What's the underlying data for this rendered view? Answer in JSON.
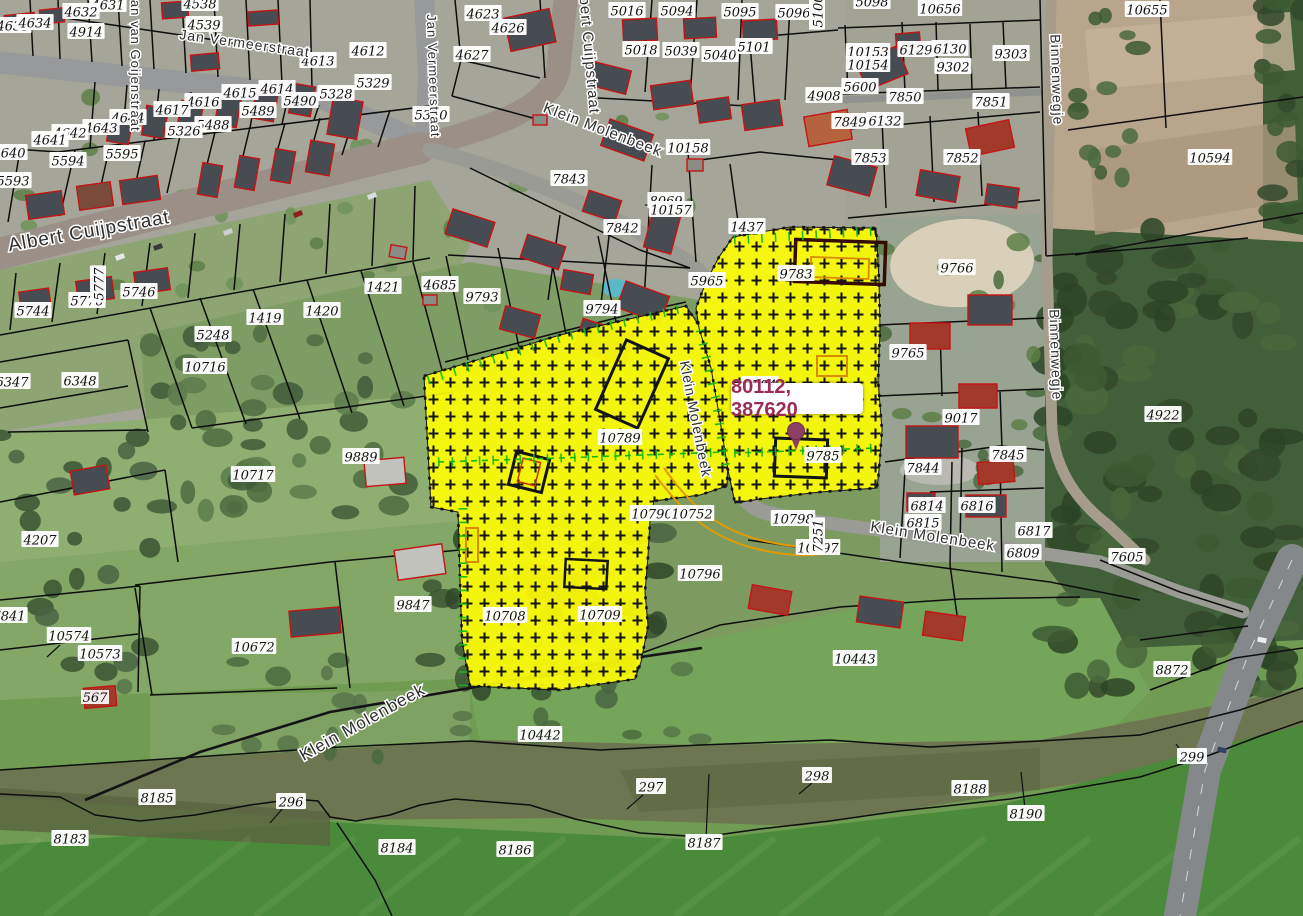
{
  "app": {
    "type": "cadastral-map-viewer",
    "description": "Aerial photo with cadastral parcels"
  },
  "map": {
    "coordinate_label": {
      "text": "80112, 387620",
      "color": "#9c2b58"
    },
    "marker": {
      "x": 796,
      "y": 431,
      "color": "#8d3f63"
    },
    "highlight": {
      "color": "#fdfc05",
      "pattern": "plus-hatch",
      "selected_parcels": [
        "10789",
        "10708",
        "10709",
        "9783",
        "9784",
        "9785"
      ]
    },
    "parcel_labels": [
      {
        "t": "4631",
        "x": 108,
        "y": 7
      },
      {
        "t": "4632",
        "x": 81,
        "y": 14
      },
      {
        "t": "4635",
        "x": 13,
        "y": 28
      },
      {
        "t": "4634",
        "x": 35,
        "y": 25
      },
      {
        "t": "4914",
        "x": 86,
        "y": 34
      },
      {
        "t": "4538",
        "x": 200,
        "y": 6
      },
      {
        "t": "4539",
        "x": 204,
        "y": 27
      },
      {
        "t": "4623",
        "x": 483,
        "y": 16
      },
      {
        "t": "4626",
        "x": 508,
        "y": 30
      },
      {
        "t": "4627",
        "x": 472,
        "y": 57
      },
      {
        "t": "4612",
        "x": 368,
        "y": 53
      },
      {
        "t": "4613",
        "x": 318,
        "y": 63
      },
      {
        "t": "4615",
        "x": 240,
        "y": 95
      },
      {
        "t": "4614",
        "x": 277,
        "y": 91
      },
      {
        "t": "4616",
        "x": 203,
        "y": 104
      },
      {
        "t": "4617",
        "x": 172,
        "y": 112
      },
      {
        "t": "4644",
        "x": 128,
        "y": 120
      },
      {
        "t": "4643",
        "x": 101,
        "y": 130
      },
      {
        "t": "4642",
        "x": 70,
        "y": 135
      },
      {
        "t": "4641",
        "x": 50,
        "y": 142
      },
      {
        "t": "4640",
        "x": 9,
        "y": 155
      },
      {
        "t": "5329",
        "x": 373,
        "y": 85
      },
      {
        "t": "5328",
        "x": 336,
        "y": 96
      },
      {
        "t": "5330",
        "x": 431,
        "y": 117
      },
      {
        "t": "5490",
        "x": 300,
        "y": 103
      },
      {
        "t": "5489",
        "x": 258,
        "y": 113
      },
      {
        "t": "5488",
        "x": 213,
        "y": 127
      },
      {
        "t": "5326",
        "x": 184,
        "y": 133
      },
      {
        "t": "5594",
        "x": 68,
        "y": 163
      },
      {
        "t": "5595",
        "x": 122,
        "y": 156
      },
      {
        "t": "5593",
        "x": 13,
        "y": 183
      },
      {
        "t": "5744",
        "x": 33,
        "y": 313
      },
      {
        "t": "5776",
        "x": 87,
        "y": 303
      },
      {
        "t": "5777",
        "x": 101,
        "y": 284,
        "r": -90
      },
      {
        "t": "5746",
        "x": 139,
        "y": 294
      },
      {
        "t": "5016",
        "x": 627,
        "y": 13
      },
      {
        "t": "5094",
        "x": 677,
        "y": 13
      },
      {
        "t": "5095",
        "x": 740,
        "y": 14
      },
      {
        "t": "5096",
        "x": 794,
        "y": 15
      },
      {
        "t": "5098",
        "x": 872,
        "y": 4
      },
      {
        "t": "5018",
        "x": 641,
        "y": 52
      },
      {
        "t": "5039",
        "x": 681,
        "y": 53
      },
      {
        "t": "5040",
        "x": 720,
        "y": 57
      },
      {
        "t": "5101",
        "x": 754,
        "y": 49
      },
      {
        "t": "5100",
        "x": 820,
        "y": 11,
        "r": -90
      },
      {
        "t": "4908",
        "x": 824,
        "y": 98
      },
      {
        "t": "5600",
        "x": 860,
        "y": 89
      },
      {
        "t": "10153",
        "x": 868,
        "y": 54
      },
      {
        "t": "10154",
        "x": 868,
        "y": 67
      },
      {
        "t": "6129",
        "x": 916,
        "y": 52
      },
      {
        "t": "6130",
        "x": 950,
        "y": 51
      },
      {
        "t": "9302",
        "x": 953,
        "y": 69
      },
      {
        "t": "9303",
        "x": 1011,
        "y": 56
      },
      {
        "t": "10656",
        "x": 940,
        "y": 11
      },
      {
        "t": "10655",
        "x": 1147,
        "y": 12
      },
      {
        "t": "7850",
        "x": 905,
        "y": 99
      },
      {
        "t": "7851",
        "x": 991,
        "y": 104
      },
      {
        "t": "7849",
        "x": 850,
        "y": 124
      },
      {
        "t": "6132",
        "x": 885,
        "y": 123
      },
      {
        "t": "7853",
        "x": 870,
        "y": 160
      },
      {
        "t": "7852",
        "x": 962,
        "y": 160
      },
      {
        "t": "10594",
        "x": 1210,
        "y": 160
      },
      {
        "t": "10158",
        "x": 688,
        "y": 150
      },
      {
        "t": "7843",
        "x": 569,
        "y": 181
      },
      {
        "t": "8069",
        "x": 666,
        "y": 203
      },
      {
        "t": "10157",
        "x": 671,
        "y": 212
      },
      {
        "t": "7842",
        "x": 622,
        "y": 230
      },
      {
        "t": "1437",
        "x": 747,
        "y": 229
      },
      {
        "t": "5965",
        "x": 707,
        "y": 283
      },
      {
        "t": "9783",
        "x": 796,
        "y": 276
      },
      {
        "t": "9766",
        "x": 957,
        "y": 270
      },
      {
        "t": "9765",
        "x": 908,
        "y": 355
      },
      {
        "t": "9793",
        "x": 482,
        "y": 299
      },
      {
        "t": "9794",
        "x": 602,
        "y": 311
      },
      {
        "t": "1421",
        "x": 383,
        "y": 289
      },
      {
        "t": "4685",
        "x": 440,
        "y": 287
      },
      {
        "t": "5248",
        "x": 213,
        "y": 337
      },
      {
        "t": "1419",
        "x": 265,
        "y": 320
      },
      {
        "t": "1420",
        "x": 322,
        "y": 313
      },
      {
        "t": "10716",
        "x": 205,
        "y": 369
      },
      {
        "t": "6348",
        "x": 80,
        "y": 383
      },
      {
        "t": "6347",
        "x": 12,
        "y": 384
      },
      {
        "t": "9889",
        "x": 361,
        "y": 459
      },
      {
        "t": "10717",
        "x": 253,
        "y": 477
      },
      {
        "t": "10789",
        "x": 620,
        "y": 440
      },
      {
        "t": "10790",
        "x": 652,
        "y": 516
      },
      {
        "t": "10752",
        "x": 692,
        "y": 516
      },
      {
        "t": "9784",
        "x": 760,
        "y": 387
      },
      {
        "t": "9785",
        "x": 823,
        "y": 458
      },
      {
        "t": "9017",
        "x": 961,
        "y": 420
      },
      {
        "t": "7845",
        "x": 1008,
        "y": 457
      },
      {
        "t": "7844",
        "x": 923,
        "y": 470
      },
      {
        "t": "4922",
        "x": 1163,
        "y": 417
      },
      {
        "t": "6814",
        "x": 927,
        "y": 508
      },
      {
        "t": "6816",
        "x": 977,
        "y": 508
      },
      {
        "t": "6815",
        "x": 923,
        "y": 525
      },
      {
        "t": "6817",
        "x": 1034,
        "y": 533
      },
      {
        "t": "6809",
        "x": 1023,
        "y": 555
      },
      {
        "t": "7605",
        "x": 1127,
        "y": 559
      },
      {
        "t": "10798",
        "x": 793,
        "y": 521
      },
      {
        "t": "10797",
        "x": 818,
        "y": 550
      },
      {
        "t": "7251",
        "x": 820,
        "y": 536,
        "r": -90
      },
      {
        "t": "10796",
        "x": 700,
        "y": 576
      },
      {
        "t": "10708",
        "x": 505,
        "y": 618
      },
      {
        "t": "10709",
        "x": 600,
        "y": 617
      },
      {
        "t": "9847",
        "x": 413,
        "y": 607
      },
      {
        "t": "10672",
        "x": 254,
        "y": 649
      },
      {
        "t": "4207",
        "x": 40,
        "y": 542
      },
      {
        "t": "7841",
        "x": 9,
        "y": 618
      },
      {
        "t": "10574",
        "x": 69,
        "y": 638
      },
      {
        "t": "10573",
        "x": 100,
        "y": 656
      },
      {
        "t": "10442",
        "x": 540,
        "y": 737
      },
      {
        "t": "10443",
        "x": 855,
        "y": 661
      },
      {
        "t": "8872",
        "x": 1172,
        "y": 672
      },
      {
        "t": "8185",
        "x": 157,
        "y": 800
      },
      {
        "t": "8183",
        "x": 70,
        "y": 841
      },
      {
        "t": "296",
        "x": 291,
        "y": 804
      },
      {
        "t": "297",
        "x": 651,
        "y": 789
      },
      {
        "t": "298",
        "x": 817,
        "y": 778
      },
      {
        "t": "299",
        "x": 1192,
        "y": 759
      },
      {
        "t": "8184",
        "x": 397,
        "y": 850
      },
      {
        "t": "8186",
        "x": 515,
        "y": 852
      },
      {
        "t": "8187",
        "x": 704,
        "y": 845
      },
      {
        "t": "8188",
        "x": 970,
        "y": 791
      },
      {
        "t": "8190",
        "x": 1026,
        "y": 816
      }
    ],
    "street_labels": [
      {
        "t": "Jan Vermeerstraat",
        "x": 244,
        "y": 48,
        "r": 8,
        "s": 14
      },
      {
        "t": "Jan van Goijenstraat",
        "x": 131,
        "y": 62,
        "r": 90,
        "s": 13
      },
      {
        "t": "Jan Vermeerstraat",
        "x": 429,
        "y": 76,
        "r": 88,
        "s": 13
      },
      {
        "t": "Albert Cuijpstraat",
        "x": 90,
        "y": 237,
        "r": -10,
        "s": 19
      },
      {
        "t": "Albert Cuijpstraat",
        "x": 584,
        "y": 48,
        "r": 85,
        "s": 15
      },
      {
        "t": "Klein Molenbeek",
        "x": 601,
        "y": 134,
        "r": 21,
        "s": 15
      },
      {
        "t": "Klein Molenbeek",
        "x": 691,
        "y": 420,
        "r": 79,
        "s": 14
      },
      {
        "t": "Klein Molenbeek",
        "x": 932,
        "y": 541,
        "r": 9,
        "s": 15
      },
      {
        "t": "Klein Molenbeek",
        "x": 365,
        "y": 727,
        "r": -29,
        "s": 17
      },
      {
        "t": "Binnenwegje",
        "x": 1052,
        "y": 80,
        "r": 88,
        "s": 14
      },
      {
        "t": "Binnenwegje",
        "x": 1051,
        "y": 355,
        "r": 88,
        "s": 14
      }
    ],
    "house_number_labels": [
      {
        "t": "567",
        "x": 95,
        "y": 700,
        "color": "#cc2222"
      }
    ]
  }
}
